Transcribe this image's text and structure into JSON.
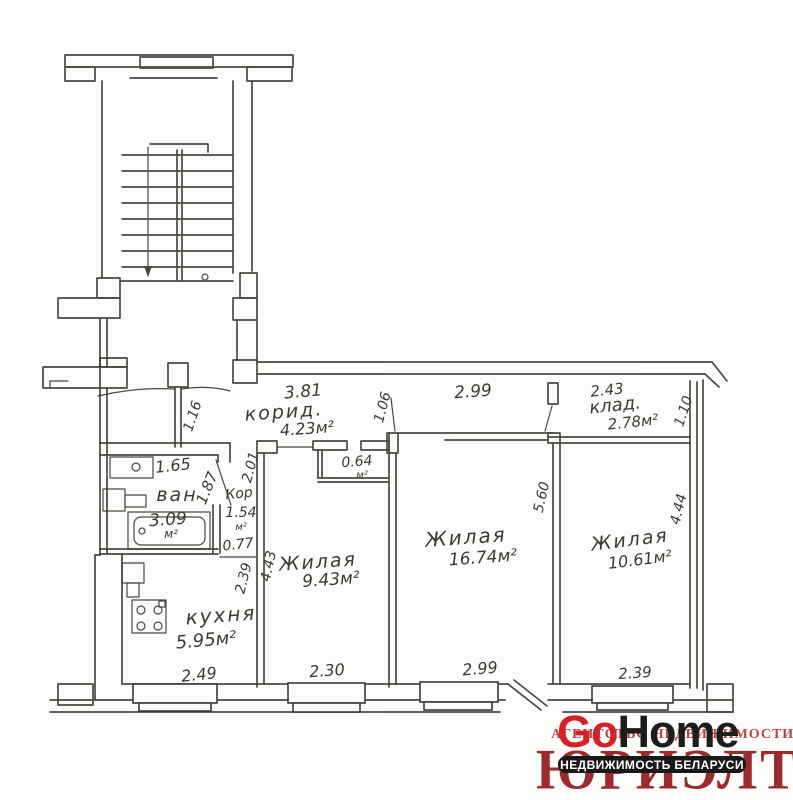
{
  "watermark": {
    "agency_line": "АГЕНТСТВО НЕДВИЖИМОСТИ",
    "brand": {
      "go": "Go",
      "home": "Home"
    },
    "brand_name": "ЮРИЭЛТ",
    "banner": "НЕДВИЖИМОСТЬ БЕЛАРУСИ",
    "colors": {
      "accent_red": "#d42127",
      "dark_red": "#9c2b2e",
      "ink_black": "#1d1d1b"
    }
  },
  "plan": {
    "entry": {
      "door_width": "1.16"
    },
    "corridor": {
      "name": "корид.",
      "area": "4.23м²",
      "width": "3.81",
      "depth": "1.06"
    },
    "pantry": {
      "name": "клад.",
      "area": "2.78м²",
      "width": "2.43",
      "depth": "1.10"
    },
    "bathroom": {
      "name": "ван",
      "area": "3.09",
      "unit": "м²",
      "width": "1.65",
      "depth": "1.87"
    },
    "hall": {
      "name": "Кор",
      "area": "1.54",
      "unit": "м²",
      "width": "0.77",
      "depth": "2.01"
    },
    "kitchen": {
      "name": "кухня",
      "area": "5.95м²",
      "window": "2.49",
      "depth": "2.39"
    },
    "closet": {
      "area": "0.64",
      "unit": "м²"
    },
    "room_a": {
      "name": "Жилая",
      "area": "9.43м²",
      "depth": "4.43",
      "window": "2.30"
    },
    "room_b": {
      "name": "Жилая",
      "area": "16.74м²",
      "width": "2.99",
      "depth": "5.60",
      "window": "2.99"
    },
    "room_c": {
      "name": "Жилая",
      "area": "10.61м²",
      "depth": "4.44",
      "window": "2.39"
    }
  }
}
